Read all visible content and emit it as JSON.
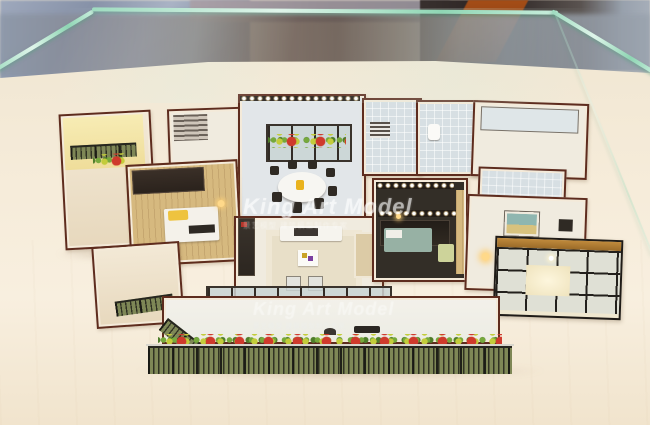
{
  "photo": {
    "subject": "architectural-scale-model-in-glass-case",
    "watermark_center": {
      "title": "King Art Model",
      "subtitle": "景艺模型 建筑模型制作专家"
    },
    "watermark_bottom": {
      "title": "King Art Model",
      "subtitle": "景艺模型 建筑模型制作专家"
    }
  },
  "palette": {
    "platform_cream": "#f6ecda",
    "wall_trim_brown": "#5e2c1e",
    "wall_face": "#f3e9d6",
    "glass_edge_green": "#9fdcc0",
    "railing_olive": "#7e8756",
    "plant_red": "#cf3a2c",
    "plant_green": "#76a93c",
    "plant_yellow": "#c3cc3a",
    "accent_yellow": "#eec33f",
    "bed_teal": "#97b1a4",
    "background_dark": "#2c2423",
    "pillar_orange": "#8a3c14",
    "marble_grey_blue": "#8792a8"
  },
  "scene_regions": [
    "showroom-background",
    "display-glass-case",
    "model-platform",
    "left-balcony-tower",
    "left-bedroom",
    "dining-room",
    "bathrooms",
    "right-bedrooms",
    "dark-bedroom",
    "living-room",
    "front-glass-doors",
    "front-balcony-with-plants",
    "sunroom-right"
  ]
}
